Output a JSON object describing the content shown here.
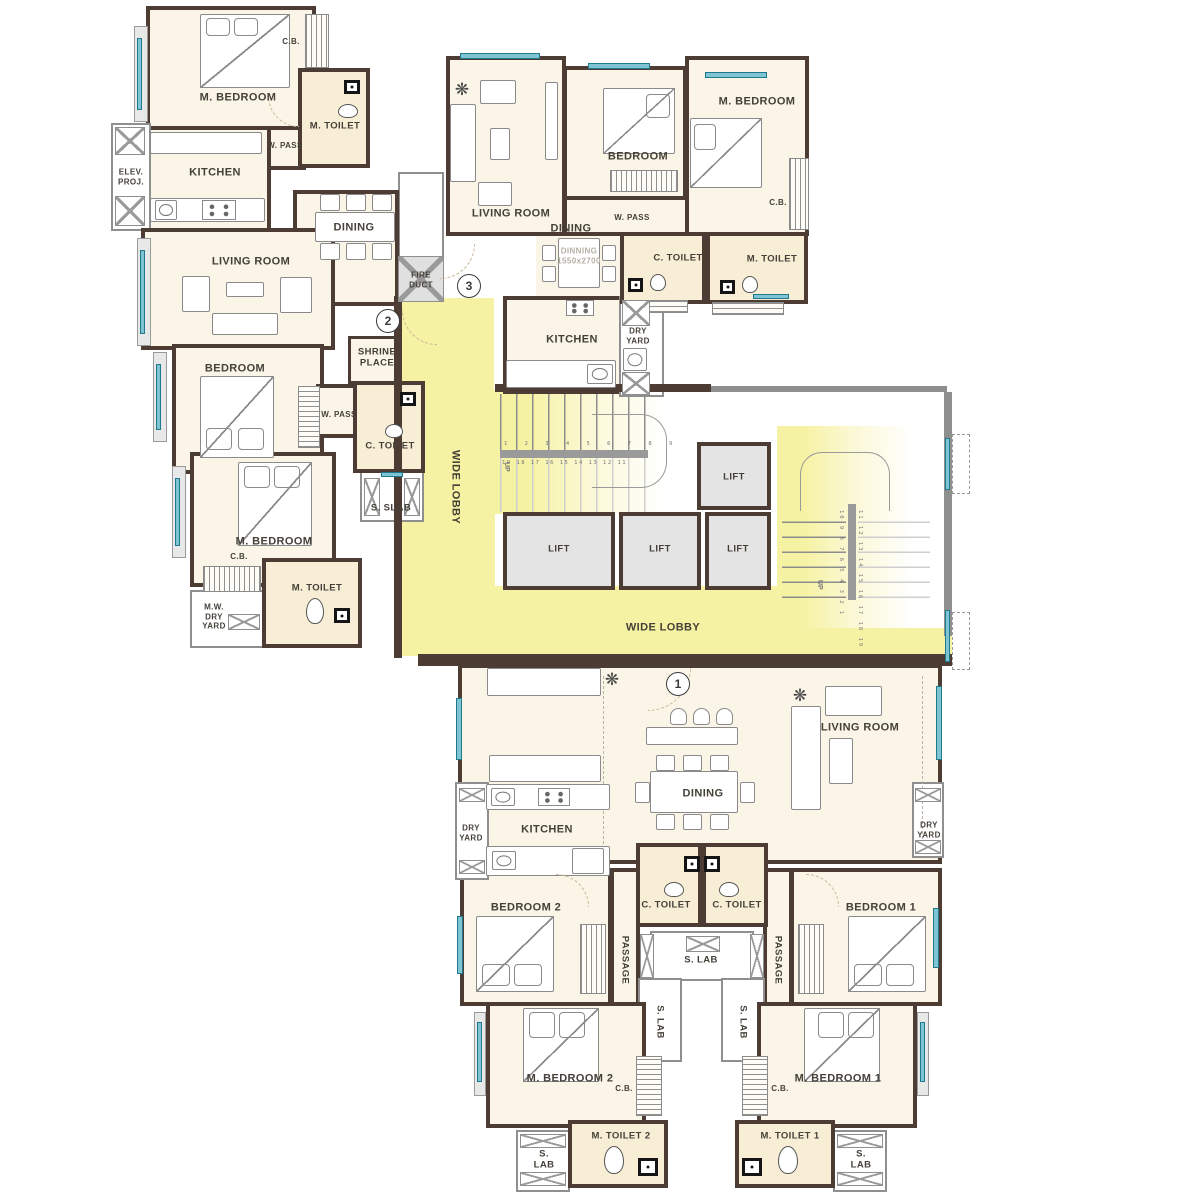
{
  "palette": {
    "wall": "#4c3c34",
    "room_fill": "#faf5e7",
    "toilet_fill": "#f8eed6",
    "lobby_yellow": "#f6f2a3",
    "window_teal": "#7fc4d2",
    "lift_gray": "#e4e4e4"
  },
  "markers": {
    "entry1": "1",
    "entry2": "2",
    "entry3": "3"
  },
  "core": {
    "wide_lobby": "WIDE LOBBY",
    "lift": "LIFT",
    "fire_duct": "FIRE\nDUCT",
    "shrine_place": "SHRINE\nPLACE",
    "up": "UP",
    "stair_top_numbers": "1 2 3 4 5 6 7 8 9",
    "stair_bottom_numbers": "19 18 17 16 15 14 13 12 11",
    "stair_right_numbers_a": "10 9 8 7 6 5 4 3 2 1",
    "stair_right_numbers_b": "11 12 13 14 15 16 17 18 19"
  },
  "unit2": {
    "m_bedroom": "M. BEDROOM",
    "cb": "C.B.",
    "m_toilet": "M. TOILET",
    "w_pass": "W. PASS",
    "kitchen": "KITCHEN",
    "elev_proj": "ELEV.\nPROJ.",
    "dining": "DINING",
    "living_room": "LIVING ROOM",
    "bedroom": "BEDROOM",
    "w_pass2": "W. PASS",
    "c_toilet": "C. TOILET",
    "s_slab": "S. SLAB",
    "m_bedroom2": "M. BEDROOM",
    "cb2": "C.B.",
    "m_toilet2": "M. TOILET",
    "mw_dry_yard": "M.W.\nDRY\nYARD"
  },
  "unit3": {
    "living_room": "LIVING ROOM",
    "bedroom": "BEDROOM",
    "m_bedroom": "M. BEDROOM",
    "cb": "C.B.",
    "w_pass": "W. PASS",
    "dining": "DINING",
    "dining_size": "DINNING\n1550x2700",
    "c_toilet": "C. TOILET",
    "m_toilet": "M. TOILET",
    "kitchen": "KITCHEN",
    "dry_yard": "DRY\nYARD"
  },
  "unit1": {
    "living_room": "LIVING ROOM",
    "dining": "DINING",
    "kitchen": "KITCHEN",
    "dry_yard_left": "DRY\nYARD",
    "dry_yard_right": "DRY\nYARD",
    "c_toilet_left": "C. TOILET",
    "c_toilet_right": "C. TOILET",
    "bedroom2": "BEDROOM 2",
    "bedroom1": "BEDROOM 1",
    "passage_left": "PASSAGE",
    "passage_right": "PASSAGE",
    "s_lab_center": "S. LAB",
    "s_lab_left": "S. LAB",
    "s_lab_right": "S. LAB",
    "m_bedroom2": "M. BEDROOM 2",
    "m_bedroom1": "M. BEDROOM 1",
    "cb_left": "C.B.",
    "cb_right": "C.B.",
    "m_toilet2": "M. TOILET 2",
    "m_toilet1": "M. TOILET 1",
    "s_lab_bl": "S.\nLAB",
    "s_lab_br": "S.\nLAB"
  }
}
